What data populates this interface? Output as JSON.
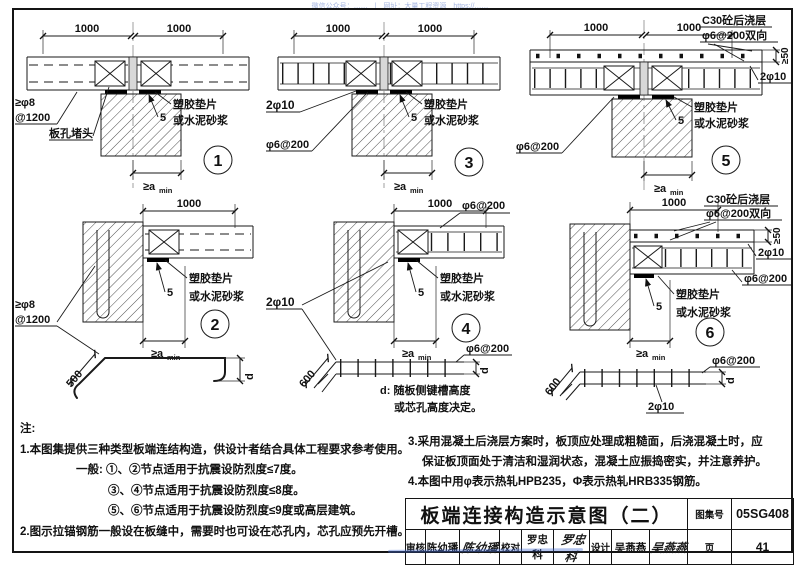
{
  "watermark": "微信公众号：……　|　网址：大量工程资源　https://……",
  "common": {
    "dim1000": "1000",
    "shim_line1": "塑胶垫片",
    "shim_line2": "或水泥砂浆",
    "five": "5",
    "amin_main": "≥a",
    "amin_sub": "min"
  },
  "panel1": {
    "num": "1",
    "rebar_line1": "≥φ8",
    "rebar_line2": "@1200",
    "plug_label": "板孔堵头"
  },
  "panel2": {
    "num": "2",
    "rebar_line1": "≥φ8",
    "rebar_line2": "@1200",
    "bar_length": "500",
    "bar_depth": "d"
  },
  "panel3": {
    "num": "3",
    "tie_bars": "2φ10",
    "mesh": "φ6@200"
  },
  "panel4": {
    "num": "4",
    "mesh_top": "φ6@200",
    "tie_bars": "2φ10",
    "mesh_label": "φ6@200",
    "bend_length": "600",
    "mesh_depth": "d",
    "d_note_line1": "d: 随板侧键槽高度",
    "d_note_line2": "或芯孔高度决定。"
  },
  "panel5": {
    "num": "5",
    "topping_line1": "C30砼后浇层",
    "topping_line2": "φ6@200双向",
    "topping_thickness": "≥50",
    "tie_bars": "2φ10",
    "mesh": "φ6@200"
  },
  "panel6": {
    "num": "6",
    "topping_line1": "C30砼后浇层",
    "topping_line2": "φ6@200双向",
    "topping_thickness": "≥50",
    "tie_bars": "2φ10",
    "slab_mesh": "φ6@200",
    "mesh_label": "φ6@200",
    "bend_length": "600",
    "mesh_depth": "d",
    "mesh_bars": "2φ10"
  },
  "notes": {
    "heading": "注:",
    "line1": "1.本图集提供三种类型板端连结构造，供设计者结合具体工程要求参考使用。",
    "line2": "一般: ①、②节点适用于抗震设防烈度≤7度。",
    "line3": "③、④节点适用于抗震设防烈度≤8度。",
    "line4": "⑤、⑥节点适用于抗震设防烈度≤9度或高层建筑。",
    "line5": "2.图示拉锚钢筋一般设在板缝中，需要时也可设在芯孔内，芯孔应预先开槽。",
    "line6": "3.采用混凝土后浇层方案时，板顶应处理成粗糙面，后浇混凝土时，应",
    "line7": "保证板顶面处于清洁和湿润状态，混凝土应振捣密实，并注意养护。",
    "line8": "4.本图中用φ表示热轧HPB235，Φ表示热轧HRB335钢筋。"
  },
  "titleblock": {
    "title": "板端连接构造示意图（二）",
    "atlas_label": "图集号",
    "atlas_number": "05SG408",
    "page_label": "页",
    "page_number": "41",
    "reviewer_label": "审核",
    "reviewer_name": "陈幼璠",
    "reviewer_signature": "陈幼璠",
    "checker_label": "校对",
    "checker_name": "罗忠科",
    "checker_signature": "罗忠科",
    "designer_label": "设计",
    "designer_name": "吴燕燕",
    "designer_signature": "吴燕燕"
  }
}
